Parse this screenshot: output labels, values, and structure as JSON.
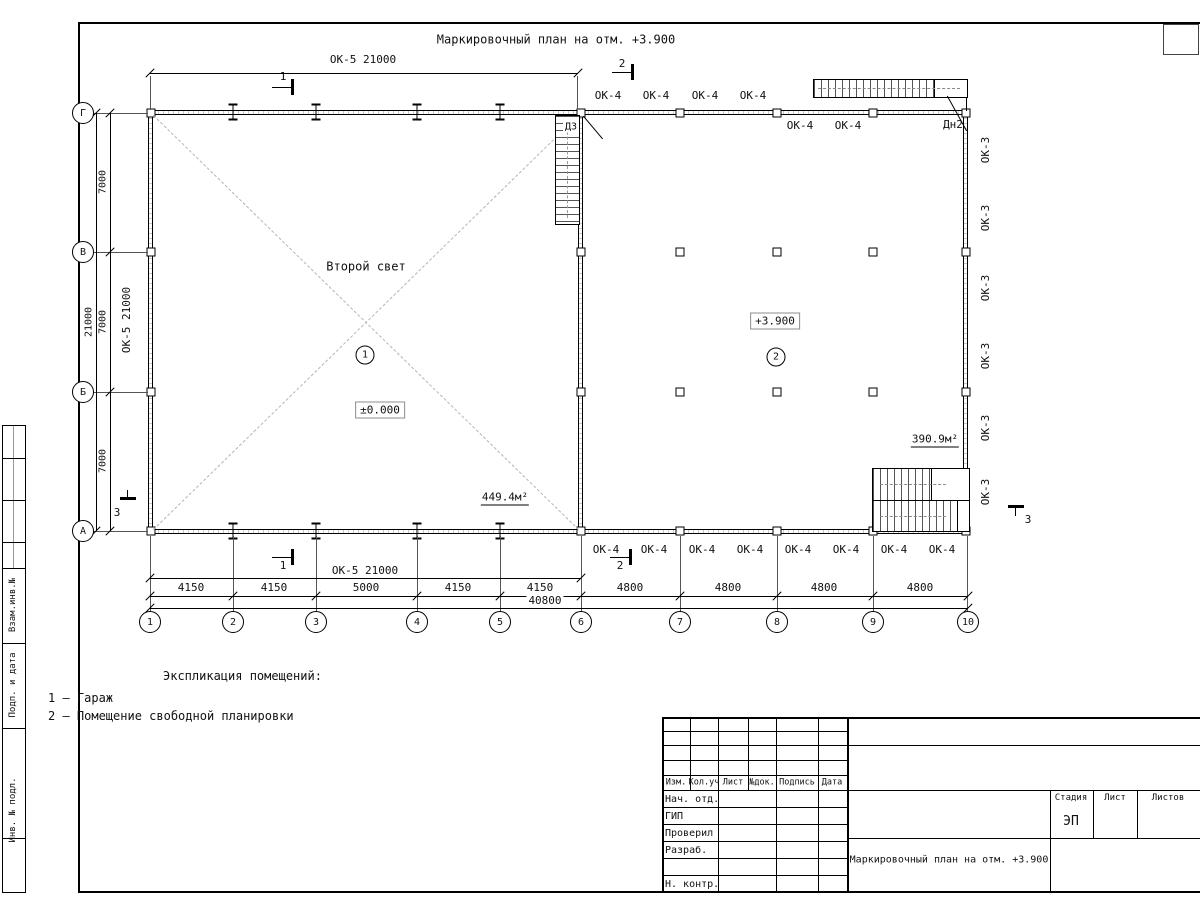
{
  "sheet": {
    "plan_title": "Маркировочный план на отм. +3.900"
  },
  "grid": {
    "letters": [
      "Г",
      "В",
      "Б",
      "А"
    ],
    "numbers": [
      "1",
      "2",
      "3",
      "4",
      "5",
      "6",
      "7",
      "8",
      "9",
      "10"
    ]
  },
  "dimensions": {
    "ok5_21000": "ОК-5 21000",
    "overall_left": "21000",
    "bay_7000": "7000",
    "bay_4150": "4150",
    "bay_5000": "5000",
    "bay_4800": "4800",
    "overall_bottom": "40800"
  },
  "marks": {
    "ok4": "ОК-4",
    "ok3": "ОК-3",
    "door_dn2": "Дн2",
    "door_d3": "Д3",
    "section_1": "1",
    "section_2": "2",
    "section_3": "3"
  },
  "rooms": {
    "garage": {
      "tag": "1",
      "note": "Второй свет",
      "level": "±0.000",
      "area": "449.4м²"
    },
    "open_plan": {
      "tag": "2",
      "level": "+3.900",
      "area": "390.9м²"
    }
  },
  "legend": {
    "heading": "Экспликация помещений:",
    "items": [
      "1 – Гараж",
      "2 – Помещение свободной планировки"
    ]
  },
  "title_block": {
    "columns": [
      "Изм.",
      "Кол.уч",
      "Лист",
      "№док.",
      "Подпись",
      "Дата"
    ],
    "rows": [
      "Нач. отд.",
      "ГИП",
      "Проверил",
      "Разраб.",
      "Н. контр."
    ],
    "stage_label": "Стадия",
    "sheet_label": "Лист",
    "sheets_label": "Листов",
    "stage_value": "ЭП",
    "doc_title": "Маркировочный план на отм. +3.900"
  },
  "side_stamp": {
    "vzam": "Взам.инв.№",
    "podp": "Подп. и дата",
    "inv": "Инв. № подл."
  }
}
